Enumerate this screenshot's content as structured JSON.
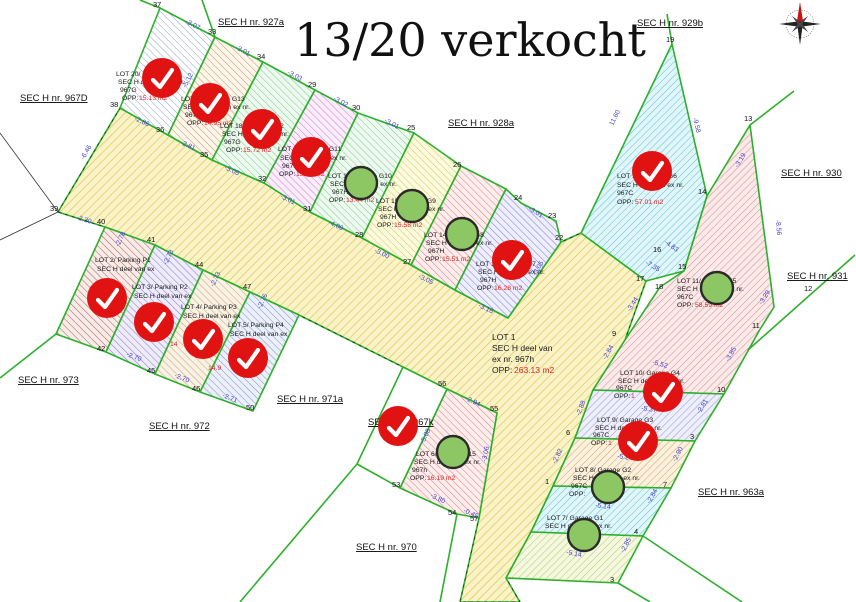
{
  "title": "13/20 verkocht",
  "labels": {
    "opp": "OPP:"
  },
  "colors": {
    "boundary_green": "#2cb02c",
    "sold_red": "#e01212",
    "available_green": "#8dc763",
    "measurement_blue": "#4343cf",
    "opp_value_red": "#e02222",
    "road_fill": "#f8f1c6"
  },
  "sections": {
    "s967d": "SEC H nr. 967D",
    "s927a": "SEC H nr. 927a",
    "s928a": "SEC H nr. 928a",
    "s929b": "SEC H nr. 929b",
    "s930": "SEC H nr. 930",
    "s931": "SEC H nr. 931",
    "s973": "SEC H nr. 973",
    "s972": "SEC H nr. 972",
    "s971a": "SEC H nr. 971a",
    "s970": "SEC H nr. 970",
    "s963a": "SEC H nr. 963a",
    "s967k": "SEC H nr. 967k"
  },
  "lots": {
    "lot1": {
      "name": "LOT 1",
      "l2": "SEC H deel van",
      "l3": "ex nr. 967h",
      "opp": "263.13 m2",
      "status": "available"
    },
    "p1": {
      "name": "LOT 2/ Parking P1",
      "l2": "SEC H deel van ex",
      "status": "sold"
    },
    "p2": {
      "name": "LOT 3/ Parking P2",
      "l2": "SEC H deel van ex",
      "status": "sold"
    },
    "p3": {
      "name": "LOT 4/ Parking P3",
      "l2": "SEC H deel van ex",
      "opp": "14",
      "status": "sold"
    },
    "p4": {
      "name": "LOT 5/ Parking P4",
      "l2": "SEC H deel van ex",
      "opp": "14.9",
      "status": "sold"
    },
    "lot6": {
      "name": "LOT 6/ Garage G15",
      "l2": "SEC H deel van ex nr.",
      "l3": "967h",
      "opp": "16.19 m2",
      "status": "available"
    },
    "lot7": {
      "name": "LOT 7/ Garage G1",
      "l2": "SEC H deel van ex nr.",
      "status": "available"
    },
    "lot8": {
      "name": "LOT 8/ Garage G2",
      "l2": "SEC H deel van ex nr.",
      "l3": "967C",
      "opp": "",
      "status": "available"
    },
    "lot9": {
      "name": "LOT 9/ Garage G3",
      "l2": "SEC H deel van ex nr.",
      "l3": "967C",
      "opp": "1",
      "status": "sold"
    },
    "lot10": {
      "name": "LOT 10/ Garage G4",
      "l2": "SEC H deel van ex nr.",
      "l3": "967C",
      "opp": "1",
      "status": "sold"
    },
    "lot11": {
      "name": "LOT 11/ Garage G5",
      "l2": "SEC H deel van ex nr.",
      "l3": "967C",
      "opp": "58.59 m2",
      "status": "available"
    },
    "lot12": {
      "name": "LOT 12/ Garage G6",
      "l2": "SEC H deel van ex nr.",
      "l3": "967C",
      "opp": "57.01 m2",
      "status": "sold"
    },
    "lot13": {
      "name": "LOT 13/ Garage G7",
      "l2": "SEC H deel van ex nr.",
      "l3": "967H",
      "opp": "16.28 m2",
      "status": "sold"
    },
    "lot14": {
      "name": "LOT 14/ Garage G8",
      "l2": "SEC H deel van ex nr.",
      "l3": "967H",
      "opp": "15.51 m2",
      "status": "available"
    },
    "lot15": {
      "name": "LOT 15/ Garage G9",
      "l2": "SEC H deel van ex nr.",
      "l3": "967H",
      "opp": "15.58 m2",
      "status": "available"
    },
    "lot16": {
      "name": "LOT 16/ Garage G10",
      "l2": "SEC H deel van ex nr.",
      "l3": "967H",
      "opp": "13.44 m2",
      "status": "available"
    },
    "lot17": {
      "name": "LOT 17/ Garage G11",
      "l2": "SEC H deel van ex nr.",
      "l3": "967H",
      "opp": "13.97 m2",
      "status": "sold"
    },
    "lot18": {
      "name": "LOT 18/ Garage G12",
      "l2": "SEC H deel van ex nr.",
      "l3": "967G",
      "opp": "15.72 m2",
      "status": "sold"
    },
    "lot19": {
      "name": "LOT 19/ Garage G13",
      "l2": "SEC H deel van ex nr.",
      "l3": "967G",
      "opp": "14.95 m2",
      "status": "sold"
    },
    "lot20": {
      "name": "LOT 20/ Garage G14",
      "l2": "SEC H deel van ex nr.",
      "l3": "967G",
      "opp": "15.13 m2",
      "status": "sold"
    }
  },
  "points": [
    "37",
    "33",
    "34",
    "29",
    "30",
    "25",
    "26",
    "24",
    "23",
    "22",
    "19",
    "13",
    "14",
    "12",
    "16",
    "15",
    "17",
    "18",
    "9",
    "11",
    "10",
    "3",
    "7",
    "6",
    "1",
    "4",
    "3",
    "38",
    "36",
    "35",
    "32",
    "31",
    "28",
    "27",
    "39",
    "40",
    "41",
    "44",
    "47",
    "42",
    "45",
    "46",
    "50",
    "53",
    "54",
    "57",
    "55",
    "56"
  ],
  "measurements": [
    "-3.07",
    "-3.01",
    "-3.03",
    "-3.02",
    "-3.01",
    "-3.01",
    "-2.86",
    "-2.81",
    "-3.05",
    "-3.01",
    "-4.00",
    "-3.00",
    "-3.05",
    "-3.16",
    "-5.12",
    "-5.11",
    "-3.05",
    "11.60",
    "-9.58",
    "-4.83",
    "-3.19",
    "-8.56",
    "-3.29",
    "-3.85",
    "-5.52",
    "-3.44",
    "-7.35",
    "-5.37",
    "-2.81",
    "-2.88",
    "-5.24",
    "-2.90",
    "-5.14",
    "-2.84",
    "-5.14",
    "-2.85",
    "-2.82",
    "-2.94",
    "-3.06",
    "-5.08",
    "-3.80",
    "-0.45",
    "-2.70",
    "-2.70",
    "-2.71",
    "-2.78",
    "-2.73",
    "-2.73",
    "-2.76",
    "-2.30",
    "-6.46",
    "-2.84"
  ]
}
